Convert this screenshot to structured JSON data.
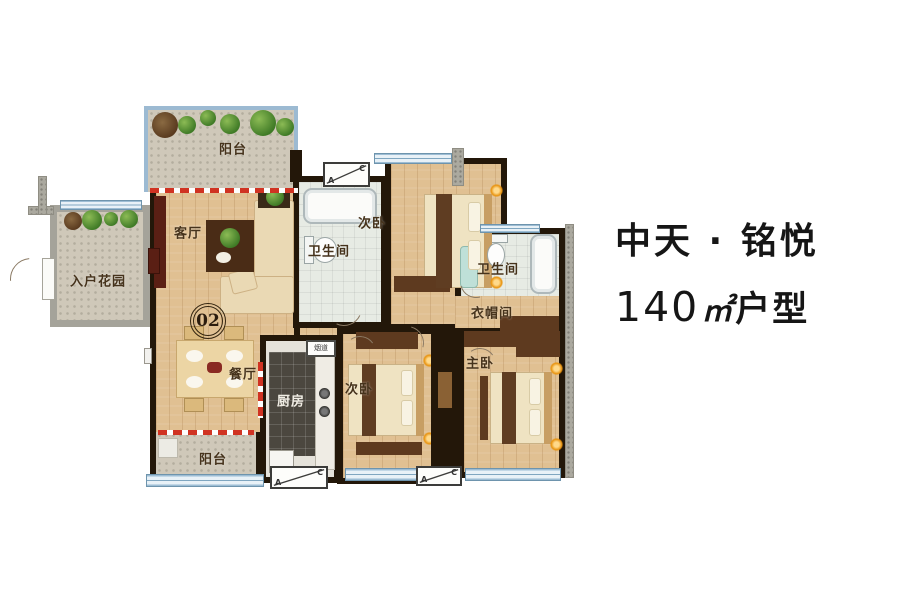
{
  "title": {
    "brand": "中天 · 铭悦",
    "area_value": "140",
    "area_unit": "㎡",
    "area_suffix": "户型"
  },
  "unit_number": "02",
  "rooms": {
    "balcony_top": "阳台",
    "living": "客厅",
    "entry_garden": "入户花园",
    "bath_1": "卫生间",
    "bedroom_top": "次卧",
    "bath_2": "卫生间",
    "closet": "衣帽间",
    "dining": "餐厅",
    "kitchen": "厨房",
    "flue": "烟道",
    "bedroom_bottom": "次卧",
    "master": "主卧",
    "balcony_bottom": "阳台"
  },
  "ac_unit": {
    "letter_a": "A",
    "letter_c": "C"
  },
  "colors": {
    "wall": "#231709",
    "wood_floor": "#e0c092",
    "stone_floor": "#cfc8b9",
    "window_blue": "#9dbdd4",
    "dashed_red": "#d03322",
    "label_text": "#46331c"
  }
}
